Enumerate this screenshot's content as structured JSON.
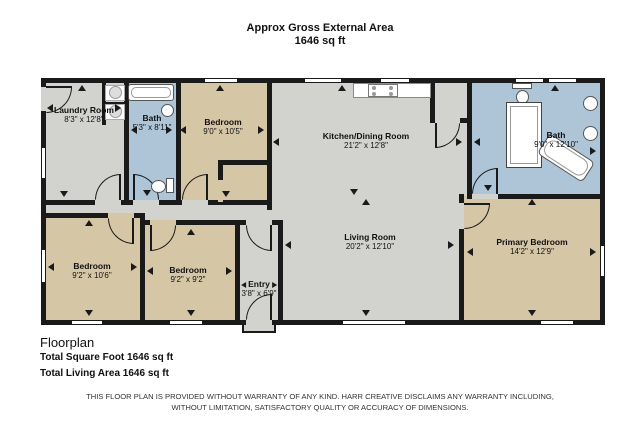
{
  "header": {
    "line1": "Approx Gross External Area",
    "line2": "1646 sq ft"
  },
  "rooms": {
    "laundry": {
      "name": "Laundry Room",
      "dims": "8'3\" x 12'8\""
    },
    "bath_small": {
      "name": "Bath",
      "dims": "5'3\" x 8'11\""
    },
    "bedroom_top": {
      "name": "Bedroom",
      "dims": "9'0\" x 10'5\""
    },
    "kitchen_dining": {
      "name": "Kitchen/Dining Room",
      "dims": "21'2\" x 12'8\""
    },
    "bath_main": {
      "name": "Bath",
      "dims": "9'0\" x 12'10\""
    },
    "bedroom_left": {
      "name": "Bedroom",
      "dims": "9'2\" x 10'6\""
    },
    "bedroom_mid": {
      "name": "Bedroom",
      "dims": "9'2\" x 9'2\""
    },
    "entry": {
      "name": "Entry",
      "dims": "3'8\" x 6'9\""
    },
    "living": {
      "name": "Living Room",
      "dims": "20'2\" x 12'10\""
    },
    "primary": {
      "name": "Primary Bedroom",
      "dims": "14'2\" x 12'9\""
    }
  },
  "footer": {
    "title": "Floorplan",
    "total_sqft": "Total Square Foot 1646 sq ft",
    "living_area": "Total Living Area 1646 sq ft"
  },
  "disclaimer": {
    "line1": "THIS FLOOR PLAN IS PROVIDED WITHOUT WARRANTY OF ANY KIND. HARR CREATIVE DISCLAIMS ANY WARRANTY INCLUDING,",
    "line2": "WITHOUT LIMITATION, SATISFACTORY QUALITY OR ACCURACY OF DIMENSIONS."
  },
  "colors": {
    "floor_gray": "#d2d2cf",
    "floor_tan": "#d5c6a6",
    "floor_blue": "#adc5d7",
    "wall": "#1a1a1a"
  }
}
